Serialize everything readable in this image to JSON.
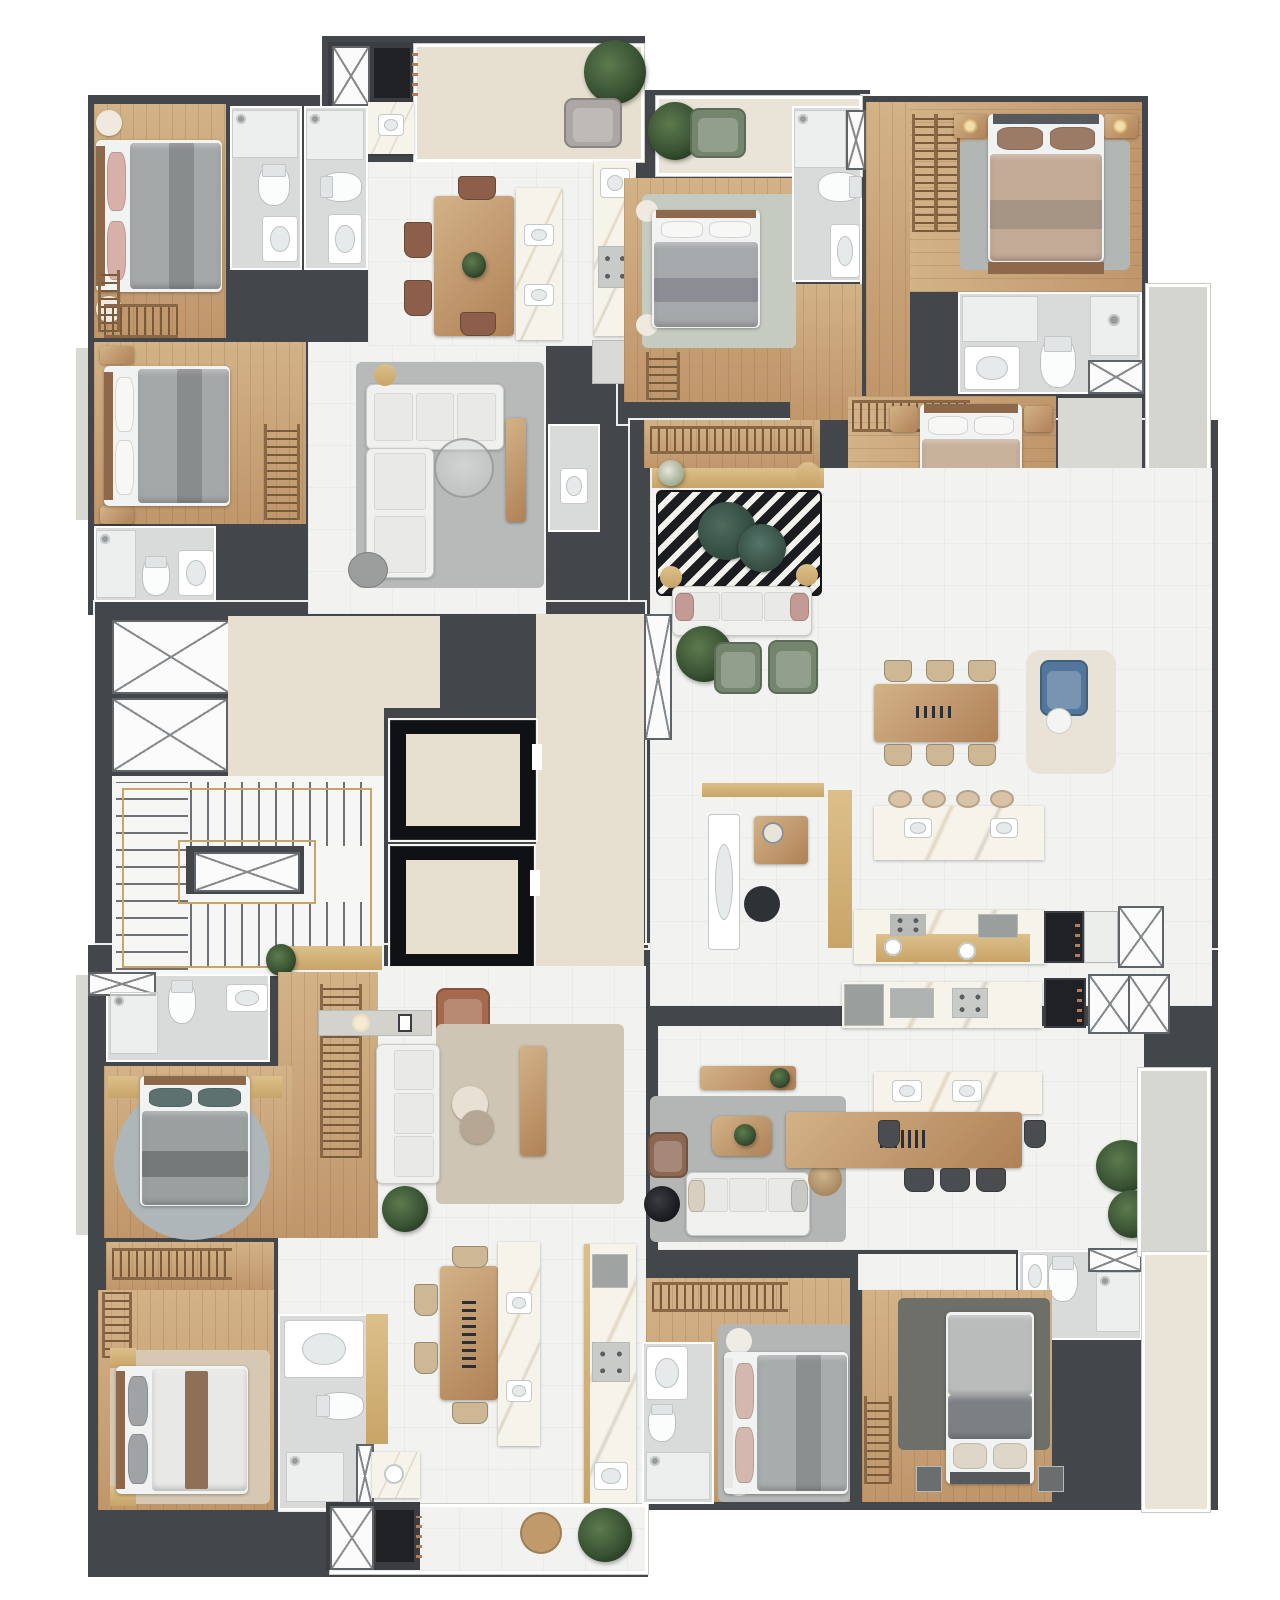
{
  "meta": {
    "title": "Residential tower – typical floor plan (top-down 3D render)",
    "view": "top-down architectural render",
    "visible_text": "none"
  },
  "palette": {
    "bg": "#ffffff",
    "wall": "#43474b",
    "woodL": "#d3b287",
    "wood": "#c0966b",
    "woodM": "#b08157",
    "woodD": "#8d684a",
    "tile": "#f2f3f1",
    "tileG": "#d8dbda",
    "tileW": "#eae4d8",
    "beige": "#e7e0d1",
    "marble": "#f6f3ea",
    "gold": "#c8a468",
    "goldL": "#dcc08a",
    "graybed": "#a4a8a8",
    "sofa": "#f0f0ee",
    "greenchair": "#74856d",
    "pink": "#d8b0aa",
    "blue": "#53779c",
    "brown": "#a56a4e"
  },
  "units": [
    {
      "id": "unit-top-left",
      "label": "Apartment 01 (top left)",
      "rooms": [
        {
          "name": "gourmet terrace",
          "furniture": [
            "service shaft",
            "barbecue grill",
            "counter with sink",
            "lounge chair",
            "plant"
          ]
        },
        {
          "name": "bedroom 1",
          "furniture": [
            "double bed",
            "round side tables",
            "closet racks"
          ]
        },
        {
          "name": "ensuite bathroom",
          "furniture": [
            "shower",
            "toilet",
            "vanity"
          ]
        },
        {
          "name": "social bathroom",
          "furniture": [
            "shower",
            "toilet",
            "vanity"
          ]
        },
        {
          "name": "master bedroom",
          "furniture": [
            "double bed",
            "nightstands",
            "wardrobe rack"
          ]
        },
        {
          "name": "bathroom 2",
          "furniture": [
            "shower",
            "toilet",
            "vanity"
          ]
        },
        {
          "name": "living room",
          "furniture": [
            "corner sofa",
            "glass coffee table",
            "gold pouf",
            "ottoman",
            "media console"
          ]
        },
        {
          "name": "kitchen and dining",
          "furniture": [
            "dining table",
            "4 chairs",
            "marble island with sinks",
            "cooktop counter",
            "sink",
            "base cabinet"
          ]
        },
        {
          "name": "powder room",
          "furniture": [
            "washbasin"
          ]
        }
      ]
    },
    {
      "id": "unit-top-center",
      "label": "Apartment 02 (top center)",
      "rooms": [
        {
          "name": "balcony",
          "furniture": [
            "green armchair",
            "plant"
          ]
        },
        {
          "name": "bedroom",
          "furniture": [
            "double bed",
            "round side tables",
            "closet rack",
            "sage rug"
          ]
        },
        {
          "name": "bathroom",
          "furniture": [
            "shower",
            "toilet",
            "vanity",
            "service shaft"
          ]
        }
      ]
    },
    {
      "id": "unit-right",
      "label": "Apartment 03 (right wing)",
      "rooms": [
        {
          "name": "suite 1",
          "furniture": [
            "double bed",
            "nightstands with lamps",
            "double closet rack",
            "gray rug",
            "foot bench"
          ]
        },
        {
          "name": "suite 1 bathroom",
          "furniture": [
            "shower tray",
            "walk-in shower",
            "toilet",
            "vanity",
            "linen cabinet"
          ]
        },
        {
          "name": "suite 2",
          "furniture": [
            "double bed",
            "nightstands",
            "closet rack"
          ]
        },
        {
          "name": "bathroom 3",
          "furniture": [
            "toilet",
            "vanity"
          ]
        },
        {
          "name": "bathroom 4",
          "furniture": [
            "glass shower",
            "toilet",
            "dark vanity",
            "linen cabinet"
          ]
        },
        {
          "name": "entry closet",
          "furniture": [
            "long coat rack",
            "console with flowers"
          ]
        },
        {
          "name": "living room",
          "furniture": [
            "chevron rug",
            "green marble coffee tables",
            "white sofa with pink pillows",
            "two green armchairs",
            "gold poufs",
            "plant",
            "service shaft"
          ]
        },
        {
          "name": "dining room",
          "furniture": [
            "wood dining table",
            "six chairs",
            "candelabra",
            "blue reading chair",
            "cream rug",
            "white pouf"
          ]
        },
        {
          "name": "kitchen",
          "furniture": [
            "marble island",
            "four stools",
            "cooktop counter",
            "two round sinks",
            "gold base cabinets",
            "oven towers",
            "linen cabinet"
          ]
        },
        {
          "name": "home office nook",
          "furniture": [
            "white desk",
            "black chair",
            "wood shelf with mirror",
            "gold wall cabinet"
          ]
        },
        {
          "name": "balcony",
          "furniture": []
        }
      ]
    },
    {
      "id": "unit-bottom-left",
      "label": "Apartment 04 (bottom left)",
      "rooms": [
        {
          "name": "entry",
          "furniture": [
            "gold console",
            "plant"
          ]
        },
        {
          "name": "living room",
          "furniture": [
            "white sofa",
            "beige rug",
            "brown leather armchair",
            "console with lamp and art",
            "round coffee tables",
            "media cabinet",
            "wardrobe wall",
            "plant"
          ]
        },
        {
          "name": "bedroom 1",
          "furniture": [
            "double bed",
            "round blue rug",
            "nightstands"
          ]
        },
        {
          "name": "bathroom 1",
          "furniture": [
            "marble shower",
            "toilet",
            "vanity",
            "linen cabinet"
          ]
        },
        {
          "name": "closet hall",
          "furniture": [
            "closet racks"
          ]
        },
        {
          "name": "bedroom 2",
          "furniture": [
            "double bed",
            "beige rug",
            "nightstands",
            "L closet racks"
          ]
        },
        {
          "name": "bathroom 2",
          "furniture": [
            "bathtub",
            "toilet",
            "shower",
            "linen panel"
          ]
        },
        {
          "name": "kitchen and dining",
          "furniture": [
            "dining table with chandelier",
            "four chairs",
            "marble island with sinks",
            "cooktop counter",
            "corner sink counter",
            "gold pantry"
          ]
        },
        {
          "name": "service terrace",
          "furniture": [
            "service shaft",
            "barbecue grill",
            "pouf",
            "plant"
          ]
        }
      ]
    },
    {
      "id": "unit-bottom-right",
      "label": "Apartment 05 (bottom right)",
      "rooms": [
        {
          "name": "living room",
          "furniture": [
            "white sofa",
            "gray rug",
            "wood coffee table with plant",
            "brown armchair",
            "black side table",
            "wicker side table",
            "media console",
            "plants"
          ]
        },
        {
          "name": "dining room",
          "furniture": [
            "long wood table",
            "five dark chairs"
          ]
        },
        {
          "name": "kitchen",
          "furniture": [
            "marble island with two sinks",
            "cooktop counter",
            "double gray sink",
            "appliance towers",
            "service shafts"
          ]
        },
        {
          "name": "bathroom 1",
          "furniture": [
            "vanity",
            "toilet",
            "shower",
            "linen cabinet"
          ]
        },
        {
          "name": "suite 1",
          "furniture": [
            "double bed",
            "gray rug",
            "closet rack",
            "round side tables"
          ]
        },
        {
          "name": "suite 1 bathroom",
          "furniture": [
            "vanity",
            "toilet",
            "shower"
          ]
        },
        {
          "name": "suite 2",
          "furniture": [
            "double bed",
            "dark rug",
            "closet rack",
            "dark nightstands"
          ]
        },
        {
          "name": "balcony",
          "furniture": [
            "plants"
          ]
        }
      ]
    },
    {
      "id": "core",
      "label": "Common core",
      "rooms": [
        {
          "name": "staircase",
          "furniture": [
            "gold handrail",
            "treads",
            "central shaft"
          ]
        },
        {
          "name": "elevator bank",
          "furniture": [
            "elevator 1",
            "elevator 2"
          ]
        },
        {
          "name": "lobby corridor",
          "furniture": []
        },
        {
          "name": "service shafts",
          "furniture": [
            "shaft 1",
            "shaft 2",
            "shaft 3"
          ]
        }
      ]
    }
  ]
}
